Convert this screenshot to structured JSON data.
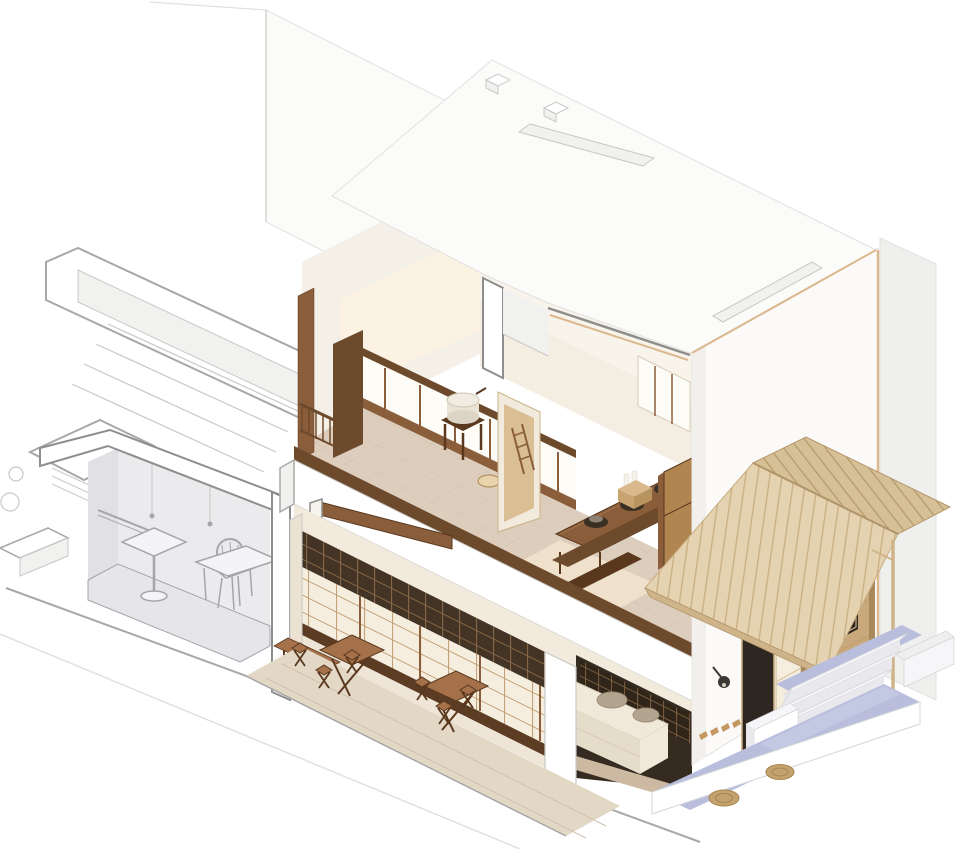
{
  "scene": {
    "kind": "architectural-axonometric-cutaway",
    "background": "#ffffff",
    "objects": [
      "two-storey cutaway building shell",
      "ghosted wireframe roof deck and parapet (left)",
      "gray unrendered service room with table and chair",
      "second-floor tea room with stone mill, window band and railing",
      "second-floor rear room with long table, braziers, crate and cabinet",
      "earthen partition wall with ladder",
      "ground-floor shoji storefront with transom lattice",
      "street walkway with folding tables and stools",
      "kitchen kamado counter with two round burners",
      "white roof plane with two skylight slots and ridge tabs",
      "front facade with display niche and vase",
      "wood-plank gabled entry awning with post",
      "entrance door, shoji slider and rammed-earth wall with window",
      "lavender entry terrace with white steps and round woven mats",
      "wall lamp and coat hooks",
      "ground plinth edge lines"
    ]
  },
  "palette": {
    "bg": "#ffffff",
    "line_faint": "#e2e1df",
    "line_light": "#c8c8c6",
    "line_mid": "#a8a8a6",
    "line_strong": "#8e8e8c",
    "white_card": "#ffffff",
    "white_face": "#fbfbfa",
    "white_face2": "#f1f1f0",
    "neighbor": "#efefee",
    "facade_white": "#fbfaf8",
    "facade_shade": "#f2f0ed",
    "wood_cut_edge": "#dcb88e",
    "cream_wall": "#f5f0e7",
    "cream_warm": "#fbf2e2",
    "cream_deep": "#f2eadc",
    "inner_white": "#f8f4ec",
    "window_bright": "#fdfcf7",
    "wood_deep": "#59381e",
    "wood_dark": "#6e4a2c",
    "wood_mid": "#8a5e3b",
    "wood_warm": "#a5714a",
    "wood_tan": "#b0854f",
    "post_tan": "#a9885c",
    "plank_light": "#e4d2b0",
    "plank_shade": "#d6c096",
    "plank_line": "#c9ad82",
    "plank_line2": "#b5976c",
    "fascia": "#cfb48a",
    "ridge": "#b2946a",
    "earth": "#c9a87c",
    "earth_line": "#b6935f",
    "earth_light": "#dabf95",
    "earth_tex": "#bb9768",
    "tile_floor": "#dccdbc",
    "tile_line": "#cbb7a3",
    "sun_patch": "#f7e9d3",
    "stone_floor": "#e3d7c6",
    "stone_line": "#d2c3af",
    "transom_dark": "#443425",
    "lat_line": "#8a6a47",
    "shoji_paper": "#f5eedf",
    "shoji_line": "#bb9264",
    "shoji_tint": "#d8c49e",
    "sill_dark": "#5c3d24",
    "base_cream": "#efe5d6",
    "corner_board": "#ece2d2",
    "counter": "#f0e9da",
    "counter_side": "#e5dcca",
    "counter_line": "#d8cdb8",
    "burner": "#b3a490",
    "burner_line": "#9c8d79",
    "k_dark": "#362b21",
    "k_lat": "#2f2519",
    "k_lat_line": "#7d5f3e",
    "k_floor": "#cdb9a2",
    "lavender": "#b9bedd",
    "lavender_light": "#ccd0e8",
    "step_white": "#f6f6f8",
    "step_shade": "#e9e9ed",
    "step_line": "#d5d5d9",
    "mat": "#c2a26e",
    "mat_line": "#a7854f",
    "ghost_wall": "#ebebee",
    "ghost_wall2": "#e1e1e5",
    "ghost_floor": "#e6e6ea",
    "ghost_line": "#a5a5a9",
    "ghost_obj": "#f4f4f6",
    "dark_opening": "#2e2620",
    "door_floor": "#8a7a64",
    "vase": "#f7f4ee",
    "vase_shadow": "#57422e",
    "lamp": "#3a3734",
    "lamp_glow": "#d9d2c4",
    "niche": "#6a4f37",
    "niche_line": "#8a6b49",
    "pot_dark": "#3a2f24",
    "pot_top": "#8d8374",
    "bottle": "#f6f3ec",
    "bottle_line": "#d8d2c4",
    "crate": "#d9b98c",
    "crate2": "#c8a470",
    "crate3": "#b7935e",
    "mill_top": "#f0ece1",
    "mill_body": "#e9e3d5",
    "mill_base": "#dcd4c5",
    "mill_line": "#cfc6b5",
    "bowl": "#e8d3ac",
    "bowl2": "#e2cca3",
    "hook": "#c49763",
    "frame_tan": "#caa87a",
    "panel_edge": "#cbb288"
  }
}
